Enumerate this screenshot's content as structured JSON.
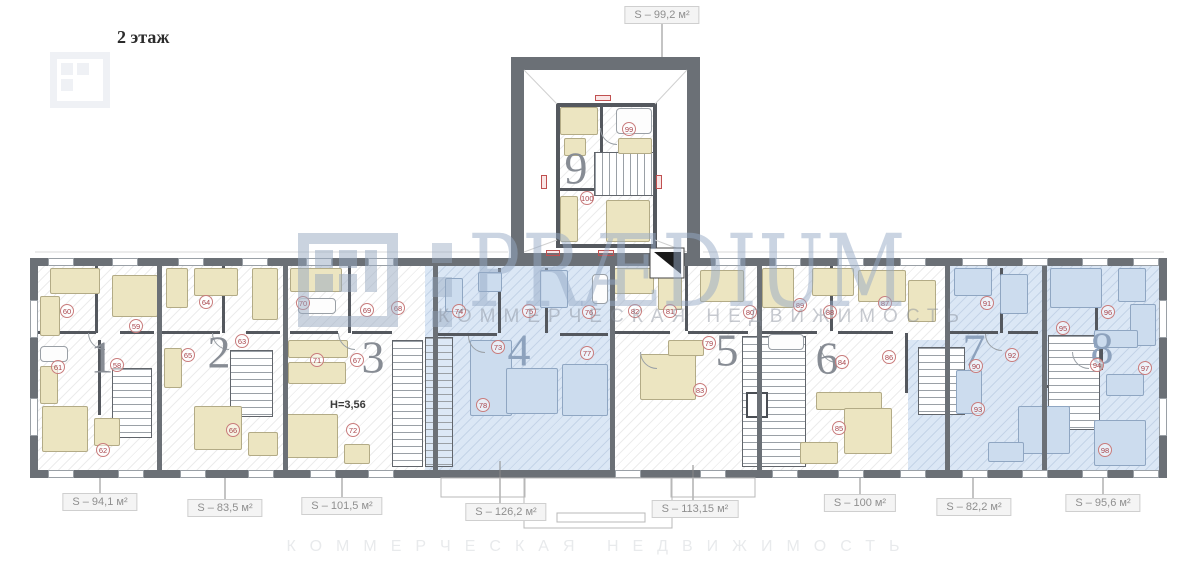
{
  "title": "2 этаж",
  "height_label": "Н=3,56",
  "watermark": {
    "brand": "PRÆDIUM",
    "tagline": "КОММЕРЧЕСКАЯ НЕДВИЖИМОСТЬ"
  },
  "area_labels": {
    "top": {
      "text": "S – 99,2 м²",
      "unit": 9
    },
    "bottom": [
      {
        "text": "S – 94,1 м²",
        "unit": 1,
        "cx": 100,
        "cy": 502
      },
      {
        "text": "S – 83,5 м²",
        "unit": 2,
        "cx": 225,
        "cy": 508
      },
      {
        "text": "S – 101,5 м²",
        "unit": 3,
        "cx": 342,
        "cy": 506
      },
      {
        "text": "S – 126,2 м²",
        "unit": 4,
        "cx": 506,
        "cy": 512
      },
      {
        "text": "S – 113,15 м²",
        "unit": 5,
        "cx": 695,
        "cy": 509
      },
      {
        "text": "S – 100 м²",
        "unit": 6,
        "cx": 860,
        "cy": 503
      },
      {
        "text": "S – 82,2 м²",
        "unit": 7,
        "cx": 974,
        "cy": 507
      },
      {
        "text": "S – 95,6 м²",
        "unit": 8,
        "cx": 1103,
        "cy": 503
      }
    ]
  },
  "units": [
    {
      "number": "1",
      "x": 102,
      "y": 357,
      "highlight": false
    },
    {
      "number": "2",
      "x": 219,
      "y": 352,
      "highlight": false
    },
    {
      "number": "3",
      "x": 373,
      "y": 357,
      "highlight": false
    },
    {
      "number": "4",
      "x": 519,
      "y": 350,
      "highlight": true
    },
    {
      "number": "5",
      "x": 727,
      "y": 350,
      "highlight": false
    },
    {
      "number": "6",
      "x": 827,
      "y": 358,
      "highlight": false
    },
    {
      "number": "7",
      "x": 974,
      "y": 350,
      "highlight": true
    },
    {
      "number": "8",
      "x": 1102,
      "y": 348,
      "highlight": true
    },
    {
      "number": "9",
      "x": 576,
      "y": 168,
      "highlight": false
    }
  ],
  "rooms": [
    {
      "n": "58",
      "unit": 1,
      "x": 117,
      "y": 365
    },
    {
      "n": "59",
      "unit": 1,
      "x": 136,
      "y": 326
    },
    {
      "n": "60",
      "unit": 1,
      "x": 67,
      "y": 311
    },
    {
      "n": "61",
      "unit": 1,
      "x": 58,
      "y": 367
    },
    {
      "n": "62",
      "unit": 1,
      "x": 103,
      "y": 450
    },
    {
      "n": "63",
      "unit": 2,
      "x": 242,
      "y": 341
    },
    {
      "n": "64",
      "unit": 2,
      "x": 206,
      "y": 302
    },
    {
      "n": "65",
      "unit": 2,
      "x": 188,
      "y": 355
    },
    {
      "n": "66",
      "unit": 2,
      "x": 233,
      "y": 430
    },
    {
      "n": "67",
      "unit": 3,
      "x": 357,
      "y": 360
    },
    {
      "n": "68",
      "unit": 3,
      "x": 398,
      "y": 308
    },
    {
      "n": "69",
      "unit": 3,
      "x": 367,
      "y": 310
    },
    {
      "n": "70",
      "unit": 3,
      "x": 303,
      "y": 303
    },
    {
      "n": "71",
      "unit": 3,
      "x": 317,
      "y": 360
    },
    {
      "n": "72",
      "unit": 3,
      "x": 353,
      "y": 430
    },
    {
      "n": "73",
      "unit": 4,
      "x": 498,
      "y": 347
    },
    {
      "n": "74",
      "unit": 4,
      "x": 459,
      "y": 311
    },
    {
      "n": "75",
      "unit": 4,
      "x": 529,
      "y": 311
    },
    {
      "n": "76",
      "unit": 4,
      "x": 589,
      "y": 312
    },
    {
      "n": "77",
      "unit": 4,
      "x": 587,
      "y": 353
    },
    {
      "n": "78",
      "unit": 4,
      "x": 483,
      "y": 405
    },
    {
      "n": "79",
      "unit": 5,
      "x": 709,
      "y": 343
    },
    {
      "n": "80",
      "unit": 5,
      "x": 750,
      "y": 312
    },
    {
      "n": "81",
      "unit": 5,
      "x": 670,
      "y": 311
    },
    {
      "n": "82",
      "unit": 5,
      "x": 635,
      "y": 311
    },
    {
      "n": "83",
      "unit": 5,
      "x": 700,
      "y": 390
    },
    {
      "n": "84",
      "unit": 6,
      "x": 842,
      "y": 362
    },
    {
      "n": "85",
      "unit": 6,
      "x": 839,
      "y": 428
    },
    {
      "n": "86",
      "unit": 6,
      "x": 889,
      "y": 357
    },
    {
      "n": "87",
      "unit": 6,
      "x": 885,
      "y": 303
    },
    {
      "n": "88",
      "unit": 6,
      "x": 830,
      "y": 312
    },
    {
      "n": "89",
      "unit": 6,
      "x": 800,
      "y": 305
    },
    {
      "n": "90",
      "unit": 7,
      "x": 976,
      "y": 366
    },
    {
      "n": "91",
      "unit": 7,
      "x": 987,
      "y": 303
    },
    {
      "n": "92",
      "unit": 7,
      "x": 1012,
      "y": 355
    },
    {
      "n": "93",
      "unit": 7,
      "x": 978,
      "y": 409
    },
    {
      "n": "94",
      "unit": 8,
      "x": 1097,
      "y": 365
    },
    {
      "n": "95",
      "unit": 8,
      "x": 1063,
      "y": 328
    },
    {
      "n": "96",
      "unit": 8,
      "x": 1108,
      "y": 312
    },
    {
      "n": "97",
      "unit": 8,
      "x": 1145,
      "y": 368
    },
    {
      "n": "98",
      "unit": 8,
      "x": 1105,
      "y": 450
    },
    {
      "n": "99",
      "unit": 9,
      "x": 629,
      "y": 129
    },
    {
      "n": "100",
      "unit": 9,
      "x": 587,
      "y": 198
    }
  ],
  "colors": {
    "wall": "#6b7076",
    "highlight_fill": "#dbe7f5",
    "room_marker": "#a8454c",
    "watermark": "#96a8c0",
    "furniture": "#ece5c1"
  }
}
